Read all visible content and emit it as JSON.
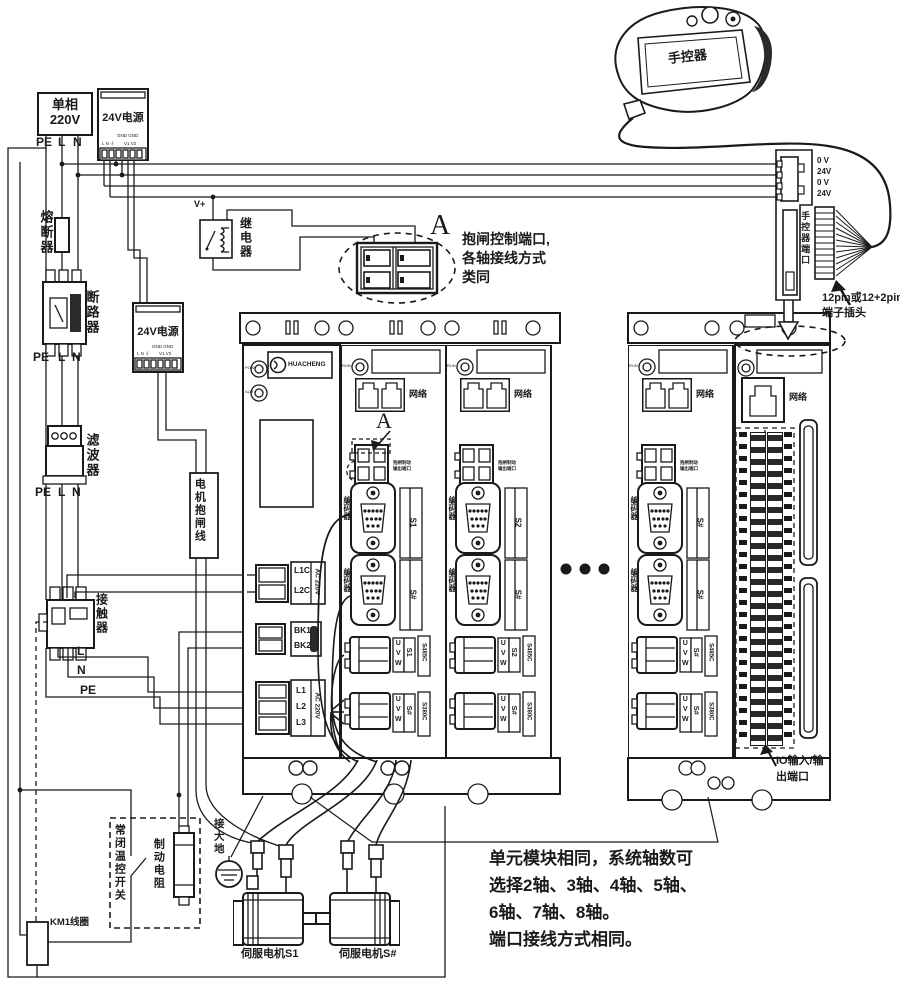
{
  "colors": {
    "ink": "#1a1a1a",
    "bg": "#ffffff"
  },
  "power": {
    "single_phase_l1": "单相",
    "single_phase_l2": "220V",
    "pe": "PE",
    "l": "L",
    "n": "N",
    "psu": "24V电源",
    "pins_ln": "L N ⏚",
    "pins_gnd": "GND GND",
    "pins_v": "V1 V2",
    "vplus": "V+"
  },
  "left_chain": {
    "fuse": "熔断器",
    "breaker": "断路器",
    "filter": "滤波器",
    "contactor": "接触器",
    "l": "L",
    "n": "N",
    "pe": "PE",
    "km1_coil": "KM1线圈",
    "thermal_switch": "常闭温控开关",
    "brake_resistor": "制动电阻",
    "relay": "继电器",
    "motor_brake_line": "电机抱闸线"
  },
  "callout_a": {
    "letter": "A",
    "line1": "抱闸控制端口,",
    "line2": "各轴接线方式",
    "line3": "类同"
  },
  "drive": {
    "logo": "HUACHENG",
    "led_pow": "POW",
    "led_alm": "ALM",
    "led_run": "RUN",
    "net": "网络",
    "t1_row1": "L1C",
    "t1_row2": "L2C",
    "t1_side": "AC 220V",
    "t2_row1": "BK1",
    "t2_row2": "BK2",
    "t3_row1": "L1",
    "t3_row2": "L2",
    "t3_row3": "L3",
    "t3_side": "AC 220V",
    "a_marker": "A",
    "brake_tag_l1": "抱闸制动",
    "brake_tag_l2": "输出端口",
    "encoder": "编码器",
    "uvw": "UVW",
    "axis_s1": "S1",
    "axis_s2": "S2",
    "axis_sn": "S#",
    "conn_side_top": "S485C",
    "conn_side_bot": "S380C",
    "io_port_l1": "IO输入/输",
    "io_port_l2": "出端口"
  },
  "handheld": {
    "name": "手控器",
    "pin1": "0 V",
    "pin2": "24V",
    "pin3": "0 V",
    "pin4": "24V",
    "port": "手控器端口",
    "plug_l1": "12pin或12+2pin",
    "plug_l2": "端子插头"
  },
  "bottom": {
    "earth": "接大地",
    "motor1": "伺服电机S1",
    "motor2": "伺服电机S#",
    "note1": "单元模块相同，系统轴数可",
    "note2": "选择2轴、3轴、4轴、5轴、",
    "note3": "6轴、7轴、8轴。",
    "note4": "端口接线方式相同。"
  }
}
